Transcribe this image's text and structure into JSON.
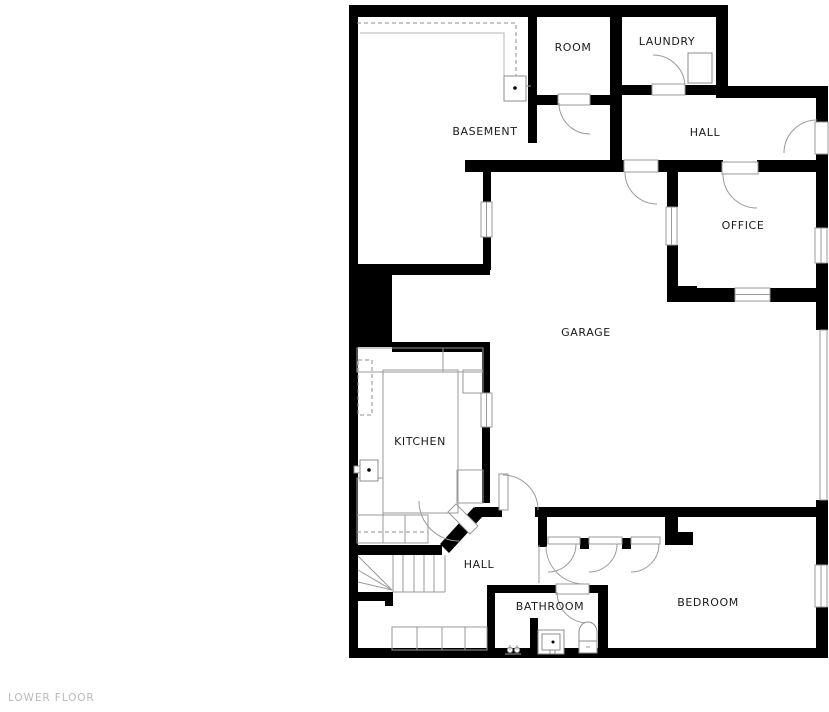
{
  "floor_plan": {
    "footer_label": "LOWER FLOOR",
    "rooms": [
      {
        "id": "basement",
        "label": "BASEMENT"
      },
      {
        "id": "room",
        "label": "ROOM"
      },
      {
        "id": "laundry",
        "label": "LAUNDRY"
      },
      {
        "id": "hall-upper",
        "label": "HALL"
      },
      {
        "id": "office",
        "label": "OFFICE"
      },
      {
        "id": "garage",
        "label": "GARAGE"
      },
      {
        "id": "kitchen",
        "label": "KITCHEN"
      },
      {
        "id": "hall-lower",
        "label": "HALL"
      },
      {
        "id": "bathroom",
        "label": "BATHROOM"
      },
      {
        "id": "bedroom",
        "label": "BEDROOM"
      }
    ],
    "colors": {
      "wall": "#000000",
      "line": "#9a9a9a",
      "label": "#1b1b1b",
      "footer": "#b9b9b9",
      "background": "#ffffff"
    }
  }
}
